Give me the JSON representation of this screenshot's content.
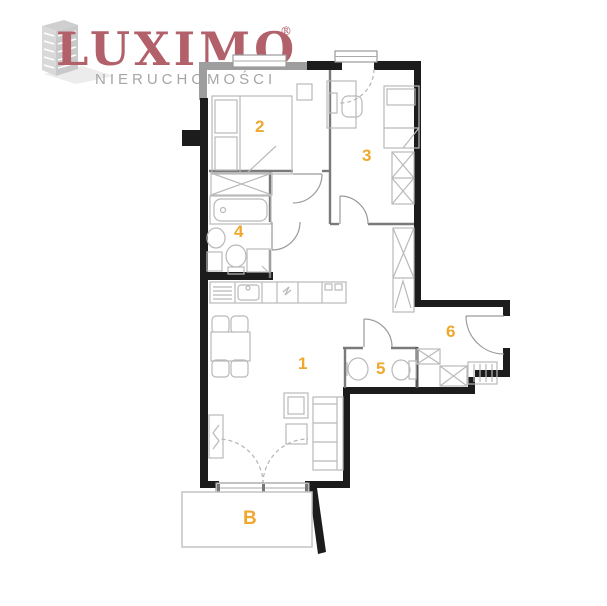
{
  "brand": {
    "name": "LUXIMO",
    "registered": "®",
    "subtitle": "NIERUCHOMOŚCI"
  },
  "floor_plan": {
    "rooms": [
      {
        "label": "1"
      },
      {
        "label": "2"
      },
      {
        "label": "3"
      },
      {
        "label": "4"
      },
      {
        "label": "5"
      },
      {
        "label": "6"
      },
      {
        "label": "B"
      }
    ]
  },
  "colors": {
    "brand": "#b2606a",
    "subtitle": "#a6a6a6",
    "room_label": "#efa72e",
    "wall": "#1c1c1c",
    "gray_wall": "#9e9e9e",
    "partition": "#7a7a7a",
    "furniture": "#b9b9b9"
  }
}
